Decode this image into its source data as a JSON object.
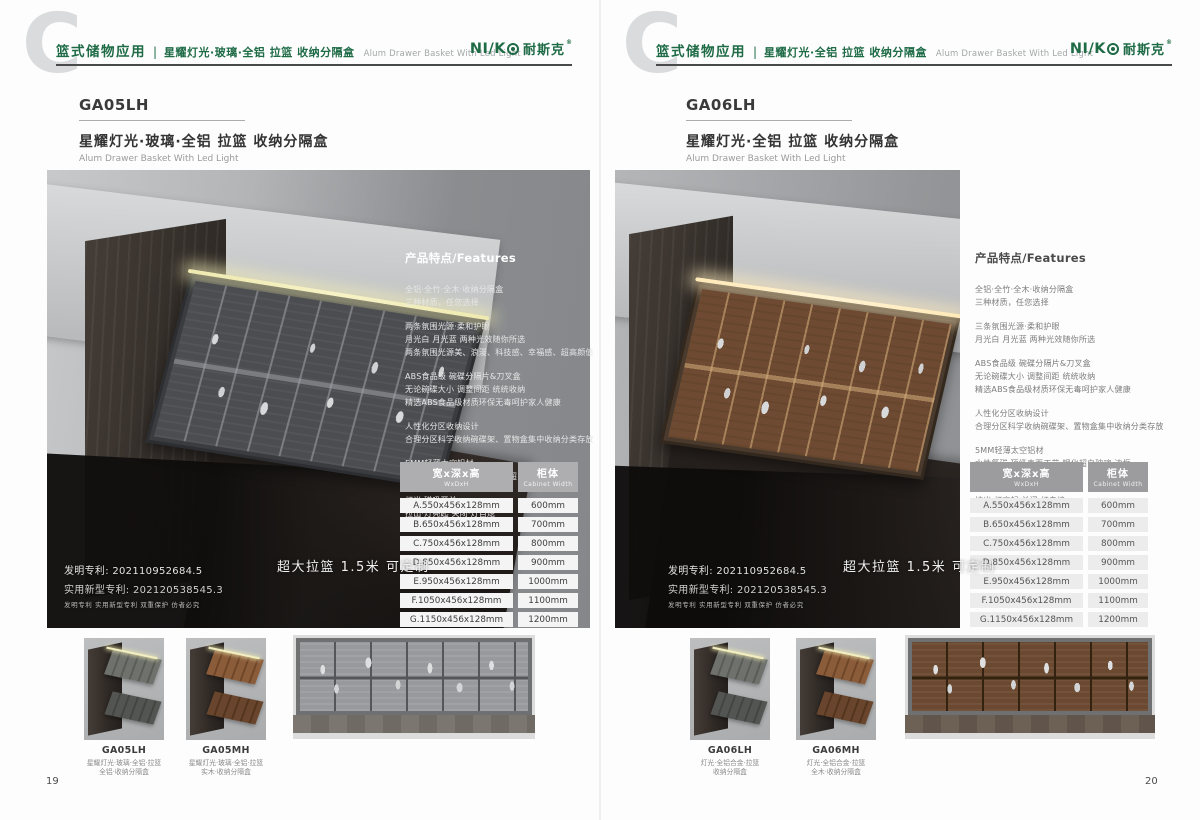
{
  "colors": {
    "brand_green": "#1e6b46"
  },
  "logo": {
    "latin": "NI/K",
    "cn": "耐斯克",
    "reg": "®"
  },
  "shared": {
    "features_heading": "产品特点/Features",
    "badge": "超大拉篮 1.5米 可定制",
    "patents": {
      "line1": "发明专利: 202110952684.5",
      "line2": "实用新型专利: 202120538545.3",
      "line3": "发明专利 实用新型专利 双重保护 仿者必究"
    }
  },
  "spec_table": {
    "header": {
      "size_cn": "宽x深x高",
      "size_en": "WxDxH",
      "cab_cn": "柜体",
      "cab_en": "Cabinet Width"
    },
    "rows": [
      {
        "size": "A.550x456x128mm",
        "cab": "600mm"
      },
      {
        "size": "B.650x456x128mm",
        "cab": "700mm"
      },
      {
        "size": "C.750x456x128mm",
        "cab": "800mm"
      },
      {
        "size": "D.850x456x128mm",
        "cab": "900mm"
      },
      {
        "size": "E.950x456x128mm",
        "cab": "1000mm"
      },
      {
        "size": "F.1050x456x128mm",
        "cab": "1100mm"
      },
      {
        "size": "G.1150x456x128mm",
        "cab": "1200mm"
      }
    ]
  },
  "left_page": {
    "header": {
      "category": "篮式储物应用",
      "divider": "|",
      "subtitle_cn": "星耀灯光·玻璃·全铝 拉篮 收纳分隔盒",
      "subtitle_en": "Alum Drawer Basket With Led Light"
    },
    "model": "GA05LH",
    "product_cn": "星耀灯光·玻璃·全铝 拉篮 收纳分隔盒",
    "product_en": "Alum Drawer Basket With Led Light",
    "features": [
      "全铝·全竹·全木·收纳分隔盒\n三种材质，任您选择",
      "两条氛围光源·柔和护眼\n月光白 月光蓝 两种光效随你所选\n两条氛围光源美、浪漫、科技感、幸福感、超高颜值",
      "ABS食品级 碗碟分隔片&刀叉盒\n无论碗碟大小 调整间距 统统收纳\n精选ABS食品级材质环保无毒呵护家人健康",
      "人性化分区收纳设计\n合理分区科学收纳碗碟架、置物盒集中收纳分类存放",
      "5MM轻薄太空铝材\n水性氟碳·顶级表面工艺 钢化超白玻璃·边框",
      "灯光·磁吸开关\n拉出·灯亮起 关闭·灯自熄"
    ],
    "thumbs": [
      {
        "model": "GA05LH",
        "desc": "星耀灯光·玻璃·全铝·拉篮\n全铝·收纳分隔盒"
      },
      {
        "model": "GA05MH",
        "desc": "星耀灯光·玻璃·全铝·拉篮\n实木·收纳分隔盒"
      }
    ],
    "page_number": "19"
  },
  "right_page": {
    "header": {
      "category": "篮式储物应用",
      "divider": "|",
      "subtitle_cn": "星耀灯光·全铝 拉篮 收纳分隔盒",
      "subtitle_en": "Alum Drawer Basket With Led Light"
    },
    "model": "GA06LH",
    "product_cn": "星耀灯光·全铝 拉篮 收纳分隔盒",
    "product_en": "Alum Drawer Basket With Led Light",
    "features": [
      "全铝·全竹·全木·收纳分隔盒\n三种材质，任您选择",
      "三条氛围光源·柔和护眼\n月光白 月光蓝 两种光效随你所选",
      "ABS食品级 碗碟分隔片&刀叉盒\n无论碗碟大小 调整间距 统统收纳\n精选ABS食品级材质环保无毒呵护家人健康",
      "人性化分区收纳设计\n合理分区科学收纳碗碟架、置物盒集中收纳分类存放",
      "5MM轻薄太空铝材\n水性氟碳·顶级表面工艺 钢化超白玻璃·边框",
      "灯光·磁吸开关\n拉出·灯亮起 关闭·灯自熄"
    ],
    "thumbs": [
      {
        "model": "GA06LH",
        "desc": "灯光·全铝合金·拉篮\n收纳分隔盒"
      },
      {
        "model": "GA06MH",
        "desc": "灯光·全铝合金·拉篮\n全木·收纳分隔盒"
      }
    ],
    "page_number": "20"
  }
}
